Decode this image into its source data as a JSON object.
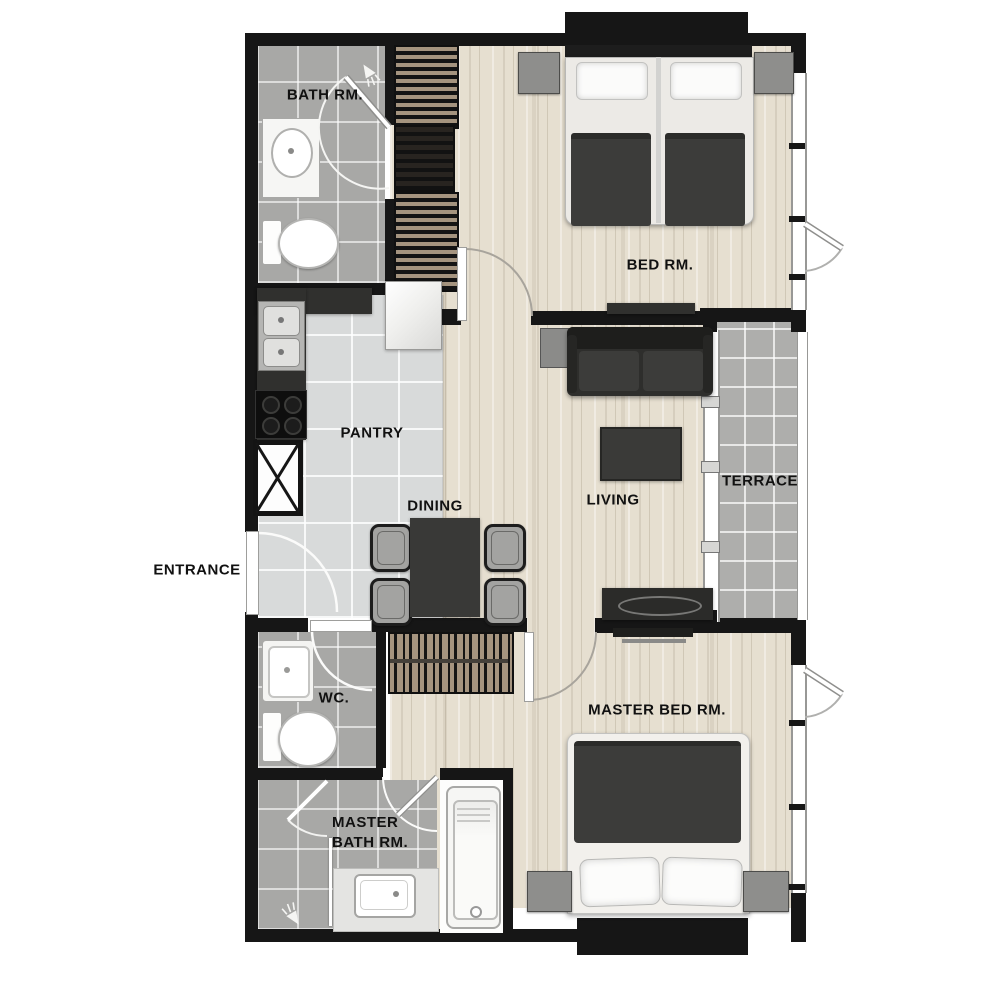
{
  "plan": {
    "type": "apartment-floor-plan",
    "labels": {
      "bath": "BATH RM.",
      "bed": "BED RM.",
      "pantry": "PANTRY",
      "dining": "DINING",
      "living": "LIVING",
      "terrace": "TERRACE",
      "entrance": "ENTRANCE",
      "wc": "WC.",
      "master_bed": "MASTER BED RM.",
      "master_bath_line1": "MASTER",
      "master_bath_line2": "BATH RM."
    },
    "icons": {
      "shower_head": "shower-head-icon",
      "door_swing": "door-swing-arc",
      "utility_shaft": "crossed-shaft-box"
    },
    "colors": {
      "wall": "#161616",
      "wood": "#e6dfd0",
      "tile_gray": "#a8a8a6",
      "tile_light": "#d8dada",
      "terrace_tile": "#aeaeac",
      "furn_dark": "#30302e",
      "wardrobe": "#a5947f",
      "nightstand": "#8e8e8c",
      "duvet": "#3c3c3a",
      "label": "#111111"
    }
  }
}
